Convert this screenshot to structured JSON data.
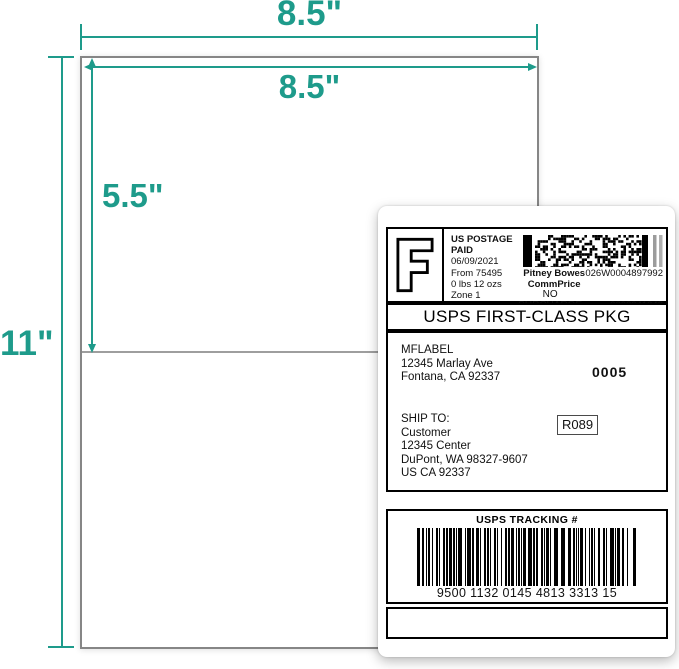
{
  "accent_color": "#1e9b8b",
  "diagram": {
    "sheet_width_label": "8.5\"",
    "inner_width_label": "8.5\"",
    "inner_height_label": "5.5\"",
    "sheet_height_label": "11\""
  },
  "label": {
    "postage": {
      "indicia_letter": "F",
      "line1": "US POSTAGE",
      "line2": "PAID",
      "date": "06/09/2021",
      "origin": "From 75495",
      "weight": "0 lbs 12 ozs",
      "zone": "Zone 1"
    },
    "meter": {
      "carrier": "Pitney Bowes",
      "meter_number": "026W0004897992",
      "rate": "CommPrice",
      "surcharge": "NO SURCHARGE",
      "serial": "3002041248"
    },
    "service": "USPS FIRST-CLASS PKG",
    "sender": {
      "name": "MFLABEL",
      "street": "12345 Marlay Ave",
      "city": "Fontana, CA 92337"
    },
    "batch_number": "0005",
    "recipient": {
      "heading": "SHIP TO:",
      "name": "Customer",
      "street": "12345 Center",
      "city": "DuPont, WA 98327-9607",
      "country": "US CA 92337"
    },
    "route_code": "R089",
    "tracking": {
      "heading": "USPS TRACKING #",
      "number": "9500 1132 0145 4813 3313 15"
    }
  }
}
